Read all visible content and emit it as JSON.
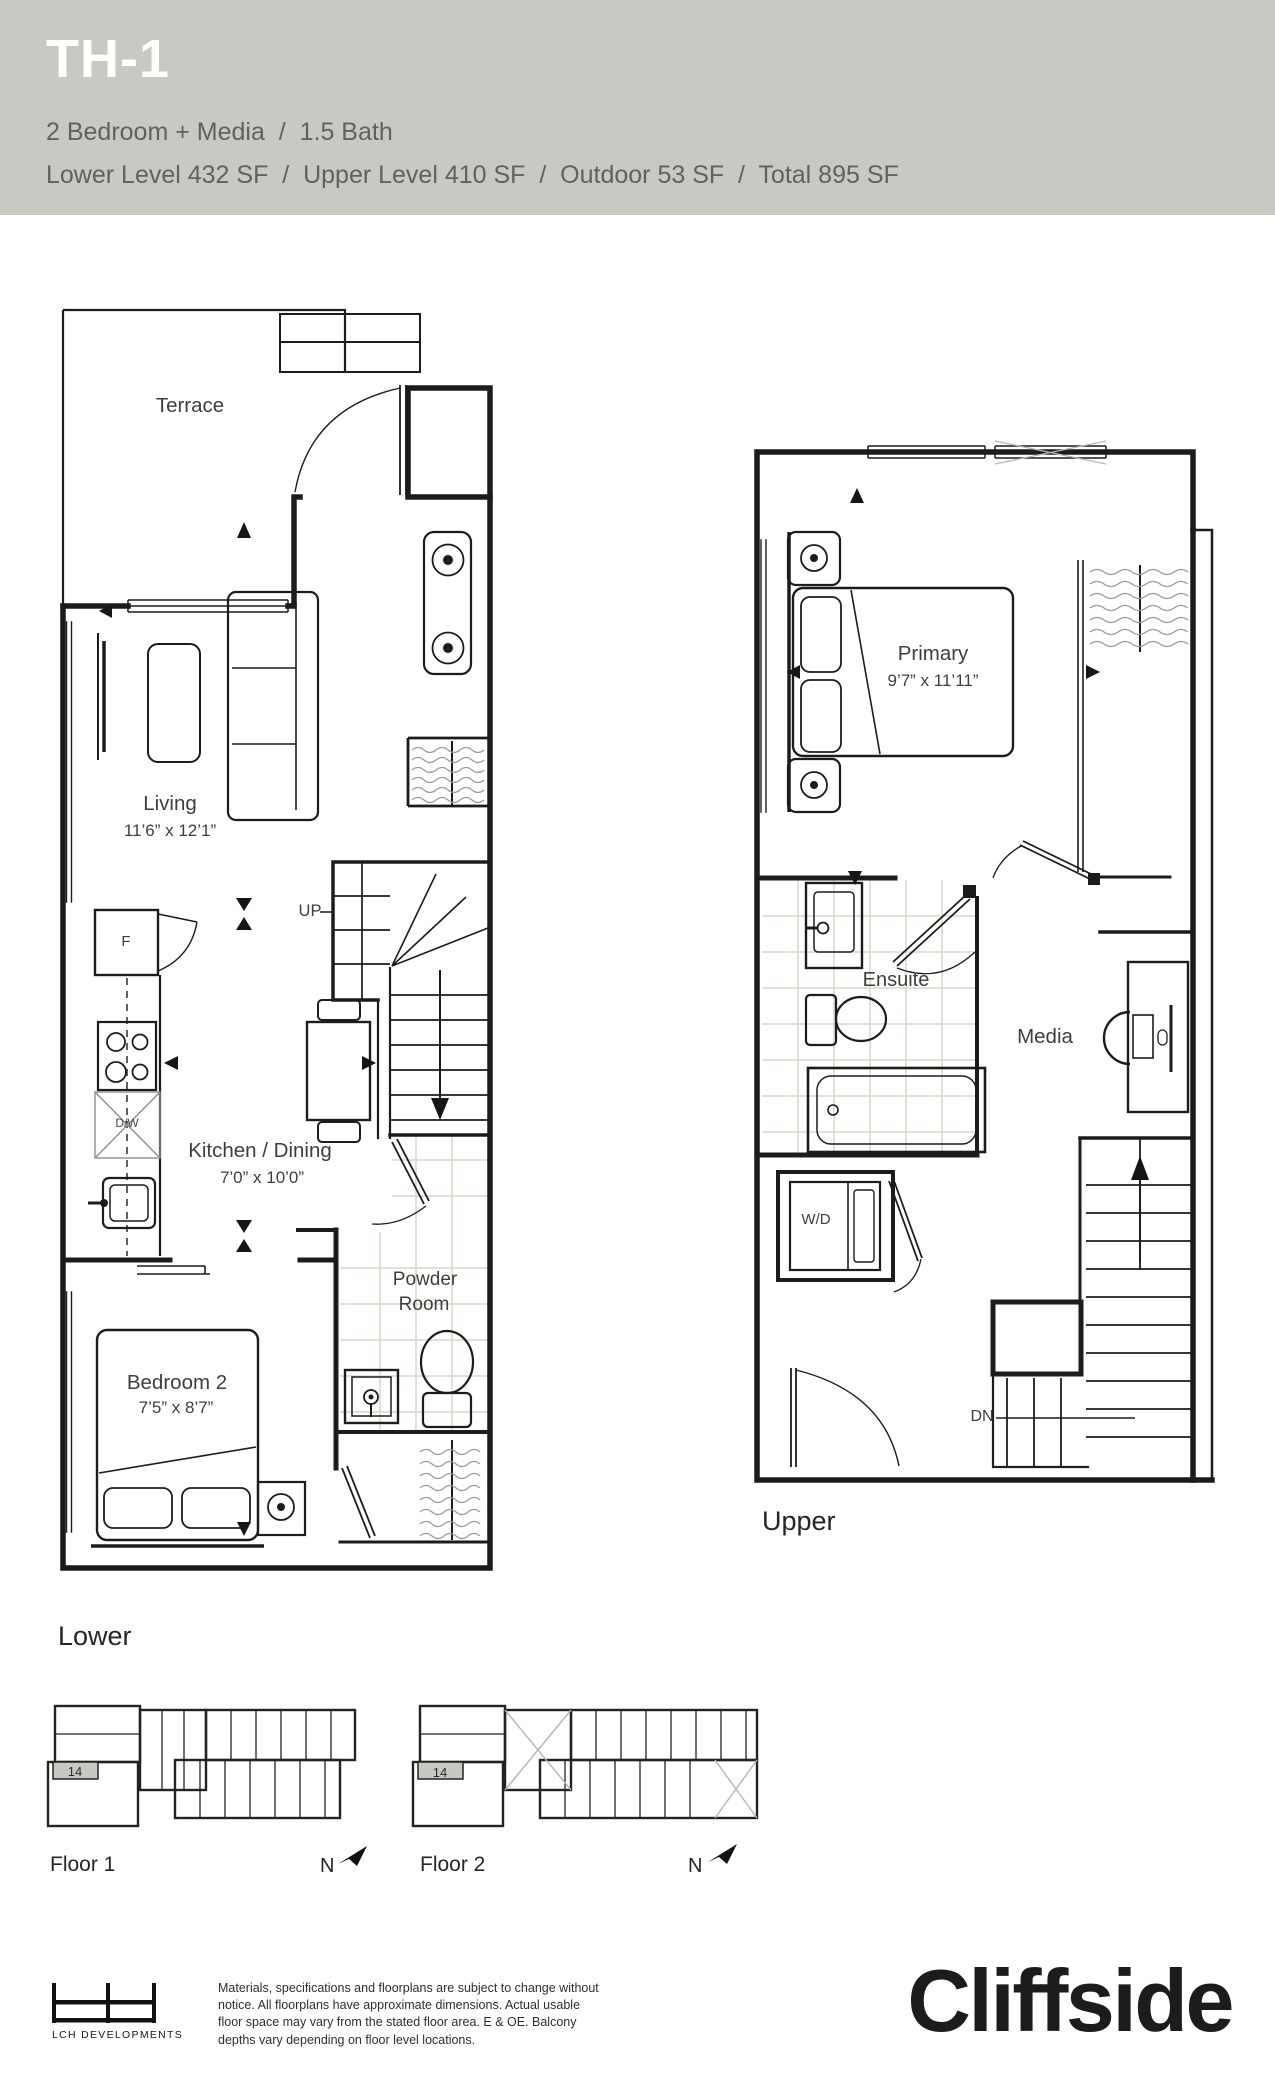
{
  "header": {
    "title": "TH-1",
    "subtitle": "2 Bedroom + Media  /  1.5 Bath",
    "areas": "Lower Level 432 SF  /  Upper Level 410 SF  /  Outdoor 53 SF  /  Total 895 SF",
    "bg_color": "#c7cac2",
    "text_color": "#5e635b"
  },
  "plans": {
    "lower": {
      "title": "Lower",
      "terrace": "Terrace",
      "living_name": "Living",
      "living_dims": "11’6” x 12’1”",
      "kitchen_name": "Kitchen / Dining",
      "kitchen_dims": "7’0” x 10’0”",
      "bedroom2_name": "Bedroom 2",
      "bedroom2_dims": "7’5” x 8’7”",
      "powder_line1": "Powder",
      "powder_line2": "Room",
      "up": "UP",
      "fridge": "F",
      "dishwasher": "D/W"
    },
    "upper": {
      "title": "Upper",
      "primary_name": "Primary",
      "primary_dims": "9’7” x 11’11”",
      "ensuite": "Ensuite",
      "media": "Media",
      "washer_dryer": "W/D",
      "down": "DN"
    }
  },
  "keyplans": {
    "floor1": {
      "label": "Floor 1",
      "unit": "14",
      "north": "N"
    },
    "floor2": {
      "label": "Floor 2",
      "unit": "14",
      "north": "N"
    }
  },
  "footer": {
    "developer": "LCH DEVELOPMENTS",
    "disclaimer_lines": [
      "Materials, specifications and floorplans are subject to change without",
      "notice. All floorplans have approximate dimensions. Actual usable",
      "floor space may vary from the stated floor area. E & OE. Balcony",
      "depths vary depending on floor level locations."
    ],
    "brand": "Cliffside"
  },
  "colors": {
    "ink": "#1c1c1c",
    "tile": "#dbd6c8",
    "shade": "#c8c8c3",
    "squiggle": "#9b9b98"
  }
}
